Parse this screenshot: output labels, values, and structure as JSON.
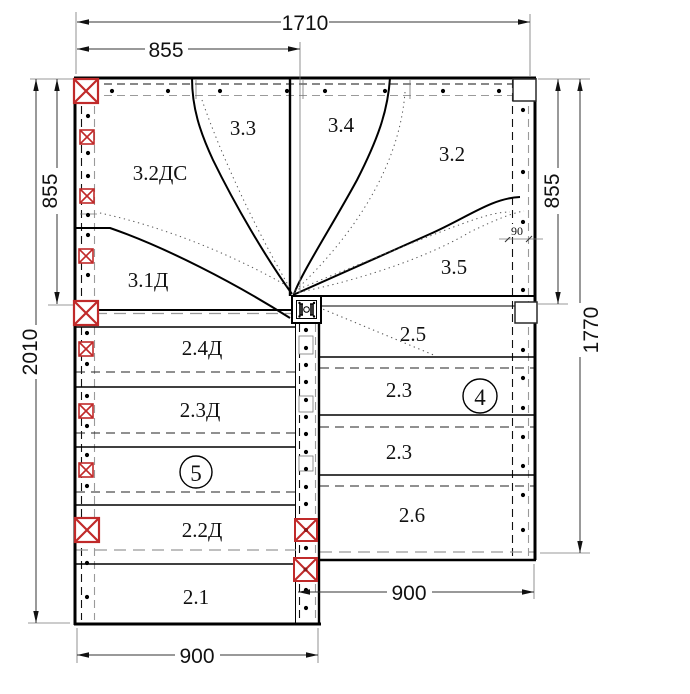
{
  "drawing": {
    "type": "staircase-assembly-plan",
    "dimensions": {
      "top_total": "1710",
      "top_left_span": "855",
      "left_upper": "855",
      "left_total": "2010",
      "right_upper": "855",
      "right_total": "1770",
      "stringer_width": "90",
      "bottom_left_flight": "900",
      "bottom_right_flight": "900"
    },
    "winder_labels": {
      "s32ds": "3.2ДС",
      "s33": "3.3",
      "s34": "3.4",
      "s32": "3.2",
      "s31d": "3.1Д",
      "s35": "3.5"
    },
    "left_flight": {
      "t24": "2.4Д",
      "t23": "2.3Д",
      "t22": "2.2Д",
      "t21": "2.1",
      "flight_number": "5"
    },
    "right_flight": {
      "t25": "2.5",
      "t23a": "2.3",
      "t23b": "2.3",
      "t26": "2.6",
      "flight_number": "4"
    },
    "colors": {
      "post_red": "#c02a2a",
      "line_black": "#000000",
      "hidden_gray": "#999999"
    }
  }
}
